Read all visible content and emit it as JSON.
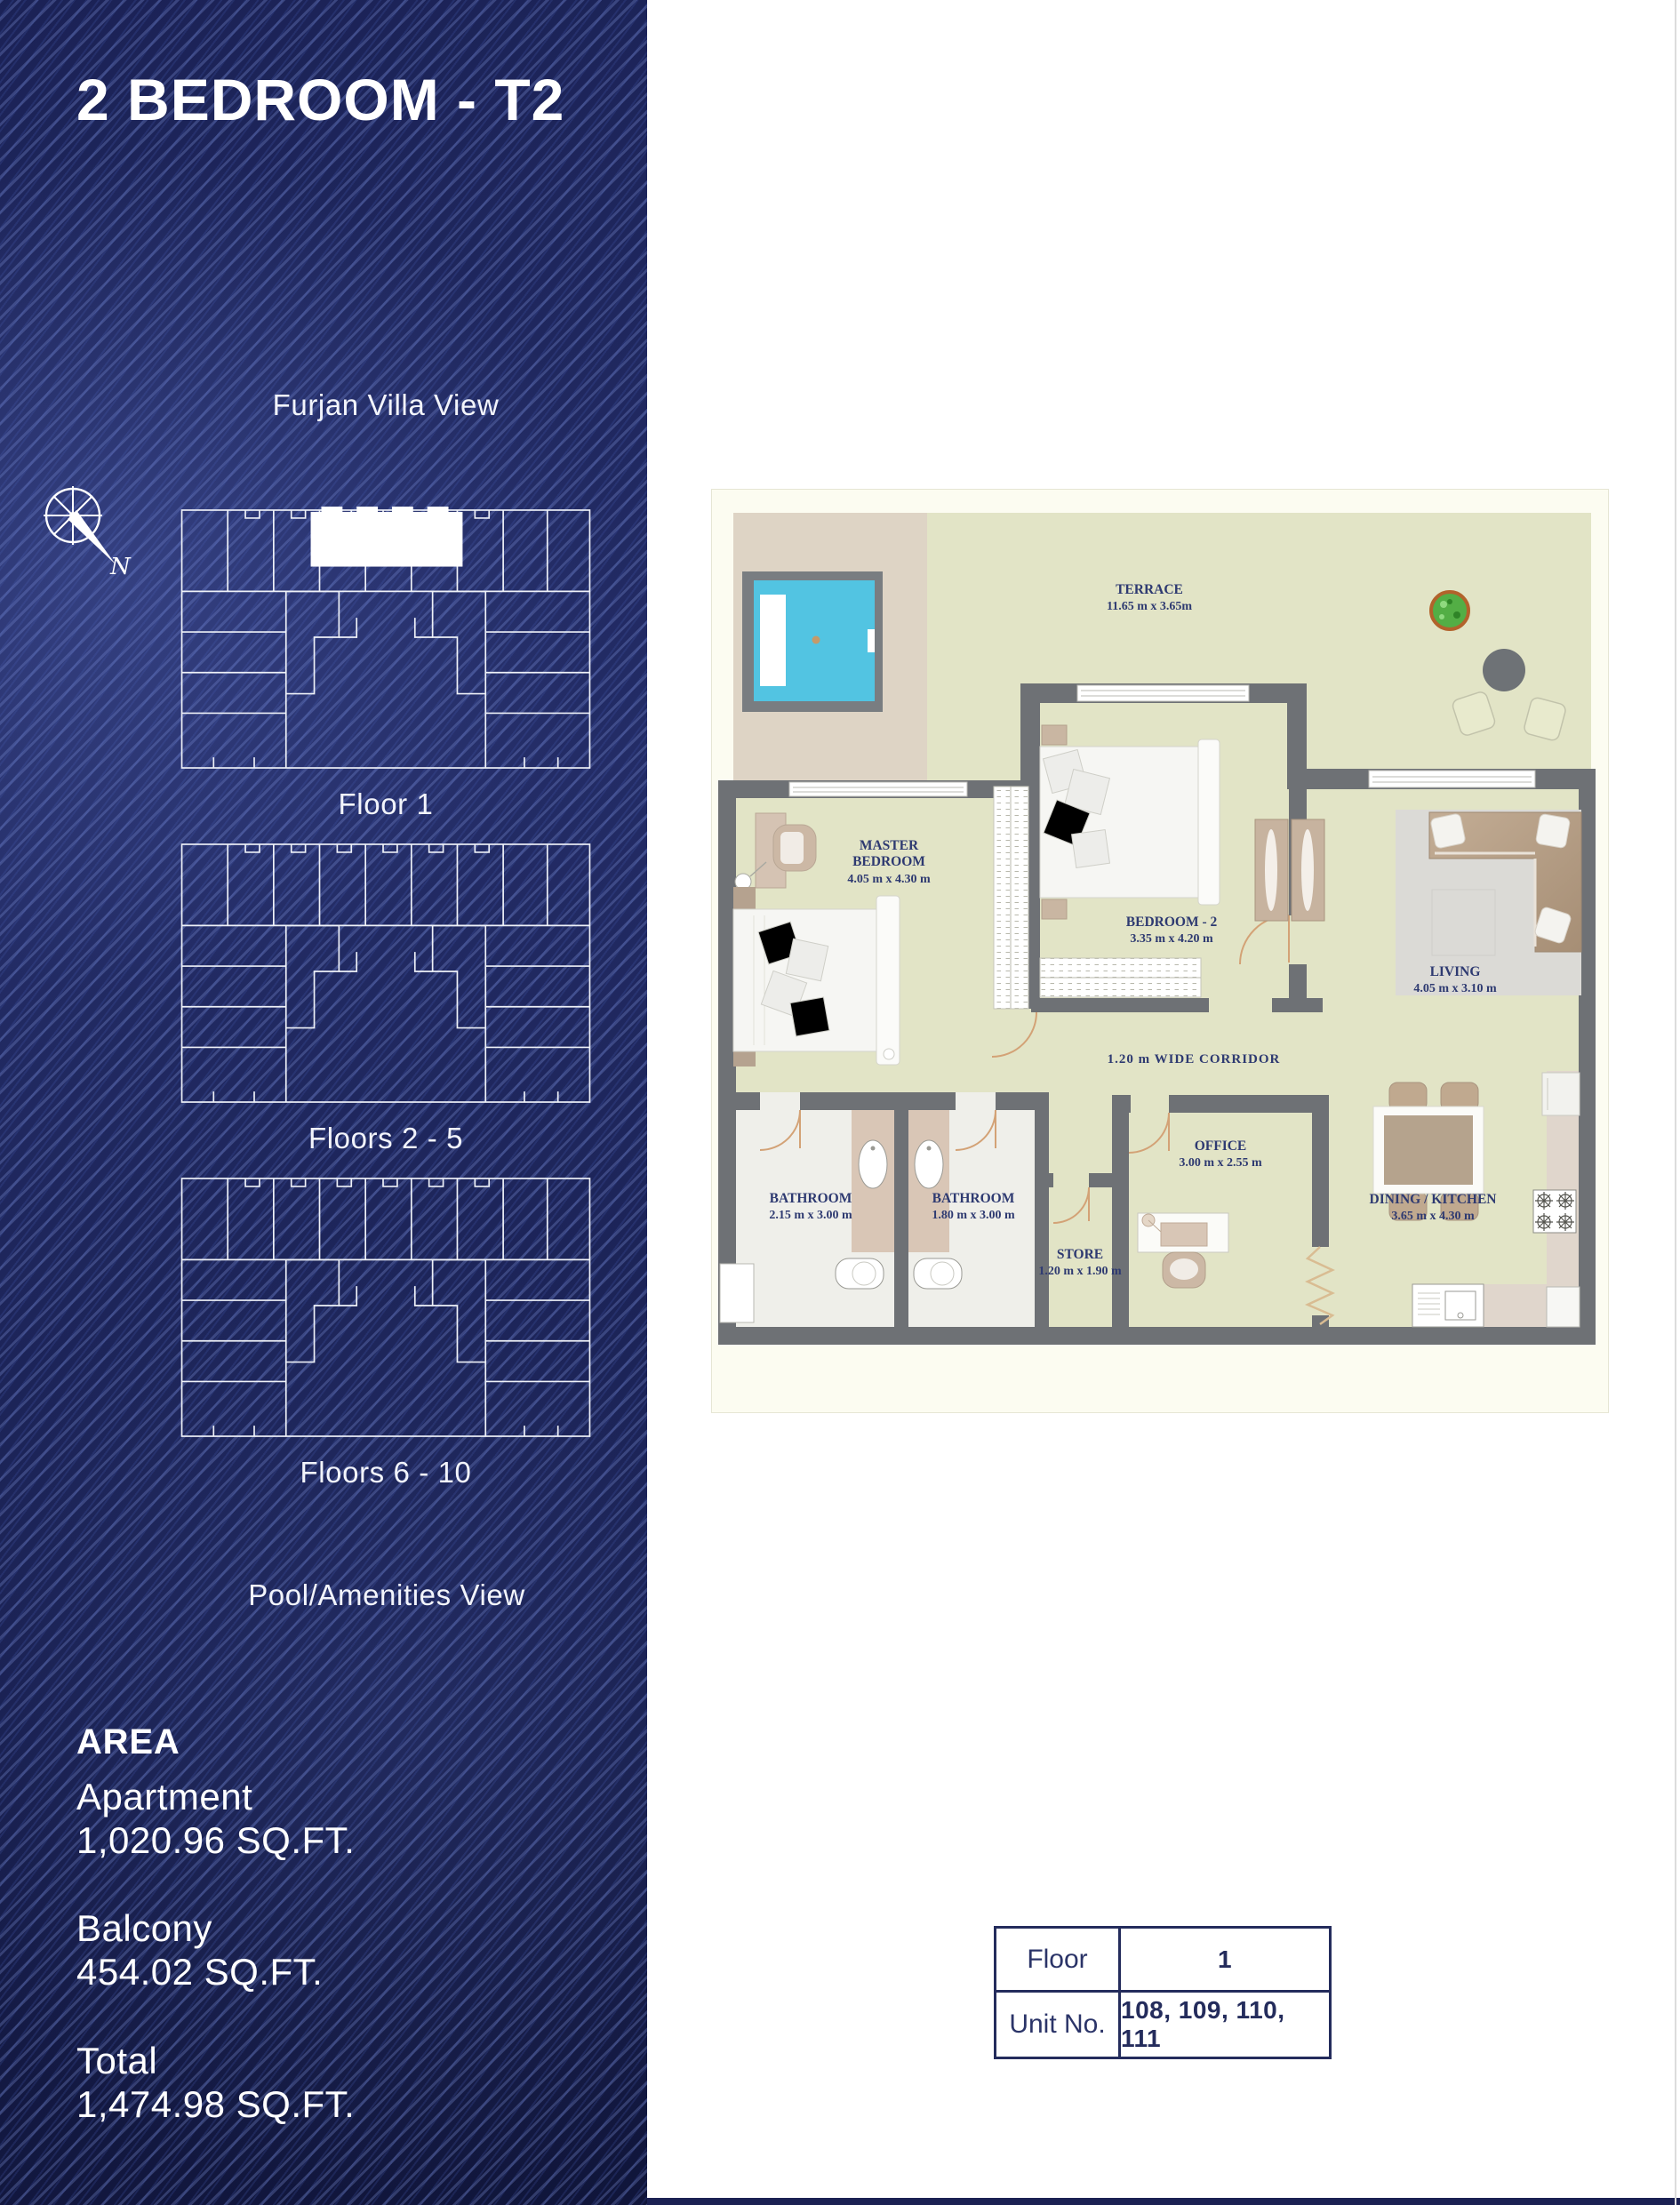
{
  "page": {
    "title": "2 BEDROOM - T2",
    "compass_letter": "N",
    "views": {
      "villa": "Furjan Villa View",
      "pool": "Pool/Amenities View"
    },
    "floor_plates": [
      {
        "label": "Floor 1",
        "highlighted": true
      },
      {
        "label": "Floors 2 - 5",
        "highlighted": false
      },
      {
        "label": "Floors 6 - 10",
        "highlighted": false
      }
    ],
    "area": {
      "heading": "AREA",
      "items": [
        {
          "label": "Apartment",
          "value": "1,020.96 SQ.FT."
        },
        {
          "label": "Balcony",
          "value": "454.02 SQ.FT."
        },
        {
          "label": "Total",
          "value": "1,474.98 SQ.FT."
        }
      ]
    }
  },
  "plan": {
    "terrace": {
      "name": "TERRACE",
      "dims": "11.65 m x 3.65m"
    },
    "master": {
      "name_line1": "MASTER",
      "name_line2": "BEDROOM",
      "dims": "4.05 m x 4.30 m"
    },
    "bedroom2": {
      "name": "BEDROOM - 2",
      "dims": "3.35 m x 4.20 m"
    },
    "living": {
      "name": "LIVING",
      "dims": "4.05 m x 3.10 m"
    },
    "bathroom1": {
      "name": "BATHROOM",
      "dims": "2.15 m x 3.00 m"
    },
    "bathroom2": {
      "name": "BATHROOM",
      "dims": "1.80 m x 3.00 m"
    },
    "office": {
      "name": "OFFICE",
      "dims": "3.00 m x 2.55 m"
    },
    "store": {
      "name": "STORE",
      "dims": "1.20 m x 1.90 m"
    },
    "dining": {
      "name": "DINING / KITCHEN",
      "dims": "3.65 m x 4.30 m"
    },
    "corridor": "1.20 m WIDE CORRIDOR"
  },
  "info_table": {
    "rows": [
      {
        "label": "Floor",
        "value": "1"
      },
      {
        "label": "Unit No.",
        "value": "108, 109, 110, 111"
      }
    ]
  },
  "colors": {
    "sidebar_navy": "#1b2256",
    "label_navy": "#2e3a71",
    "olive": "#e2e4c6",
    "beige": "#ded4c5",
    "pool_cyan": "#52c4e2",
    "wall_gray": "#6e7175",
    "tan": "#cdb7a2"
  }
}
